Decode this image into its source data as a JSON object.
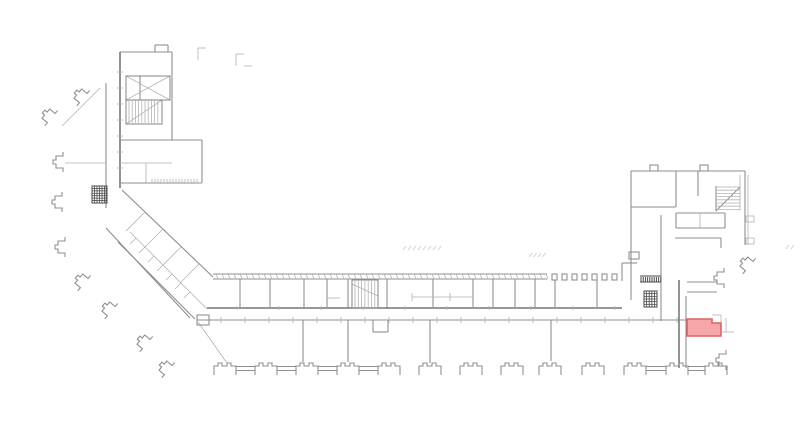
{
  "meta": {
    "width": 800,
    "height": 428,
    "background": "#ffffff",
    "description": "architectural floor plan with one room highlighted"
  },
  "styles": {
    "w": {
      "c": "#8f8f8f",
      "sw": 1.1
    },
    "W": {
      "c": "#767676",
      "sw": 1.6
    },
    "t": {
      "c": "#b3b3b3",
      "sw": 0.8
    },
    "d": {
      "c": "#4a4a4a",
      "sw": 1.0
    },
    "f": {
      "c": "#cfcfcf",
      "sw": 0.9
    }
  },
  "highlight": {
    "fill": "#f6a6a6",
    "stroke": "#da6363",
    "stroke_width": 1.6,
    "points": "687,319 712,319 712,323 721,323 721,336 687,336"
  },
  "plan": {
    "segments": [
      [
        155,
        45,
        168,
        45,
        "w"
      ],
      [
        155,
        45,
        155,
        52,
        "w"
      ],
      [
        168,
        45,
        168,
        52,
        "w"
      ],
      [
        120,
        52,
        172,
        52,
        "w"
      ],
      [
        120,
        52,
        120,
        188,
        "W"
      ],
      [
        172,
        52,
        172,
        140,
        "w"
      ],
      [
        140,
        76,
        140,
        100,
        "w"
      ],
      [
        126,
        76,
        170,
        100,
        "t"
      ],
      [
        126,
        100,
        170,
        76,
        "t"
      ],
      [
        126,
        124,
        162,
        100,
        "t"
      ],
      [
        120,
        140,
        172,
        140,
        "w"
      ],
      [
        120,
        163,
        172,
        163,
        "t"
      ],
      [
        146,
        163,
        146,
        183,
        "t"
      ],
      [
        152,
        140,
        202,
        140,
        "w"
      ],
      [
        202,
        140,
        202,
        183,
        "w"
      ],
      [
        120,
        183,
        202,
        183,
        "w"
      ],
      [
        106,
        83,
        106,
        208,
        "w"
      ],
      [
        65,
        163,
        106,
        163,
        "t"
      ],
      [
        100,
        88,
        62,
        126,
        "t"
      ],
      [
        198,
        48,
        198,
        60,
        "t"
      ],
      [
        198,
        48,
        206,
        48,
        "t"
      ],
      [
        236,
        54,
        236,
        66,
        "t"
      ],
      [
        236,
        54,
        244,
        54,
        "t"
      ],
      [
        244,
        66,
        252,
        66,
        "t"
      ],
      [
        122,
        190,
        213,
        277,
        "w"
      ],
      [
        106,
        228,
        190,
        318,
        "w"
      ],
      [
        118,
        242,
        195,
        319,
        "w"
      ],
      [
        130,
        232,
        207,
        309,
        "t"
      ],
      [
        145,
        212,
        126,
        231,
        "t"
      ],
      [
        163,
        229,
        144,
        248,
        "t"
      ],
      [
        181,
        247,
        162,
        266,
        "t"
      ],
      [
        199,
        264,
        180,
        283,
        "t"
      ],
      [
        198,
        322,
        227,
        363,
        "t"
      ],
      [
        213,
        274,
        547,
        274,
        "w"
      ],
      [
        213,
        279,
        547,
        279,
        "w"
      ],
      [
        240,
        279,
        240,
        307,
        "w"
      ],
      [
        270,
        279,
        270,
        307,
        "w"
      ],
      [
        304,
        279,
        304,
        307,
        "w"
      ],
      [
        327,
        279,
        327,
        307,
        "w"
      ],
      [
        327,
        298,
        340,
        298,
        "t"
      ],
      [
        348,
        279,
        348,
        308,
        "w"
      ],
      [
        387,
        279,
        387,
        308,
        "w"
      ],
      [
        352,
        284,
        378,
        296,
        "t"
      ],
      [
        433,
        279,
        433,
        307,
        "w"
      ],
      [
        473,
        279,
        473,
        307,
        "w"
      ],
      [
        493,
        279,
        493,
        307,
        "w"
      ],
      [
        515,
        279,
        515,
        307,
        "w"
      ],
      [
        535,
        279,
        535,
        307,
        "w"
      ],
      [
        555,
        280,
        555,
        307,
        "w"
      ],
      [
        597,
        280,
        597,
        307,
        "w"
      ],
      [
        412,
        297,
        472,
        297,
        "t"
      ],
      [
        412,
        293,
        412,
        301,
        "t"
      ],
      [
        450,
        293,
        450,
        301,
        "t"
      ],
      [
        207,
        308,
        622,
        308,
        "W"
      ],
      [
        197,
        320,
        686,
        320,
        "w"
      ],
      [
        373,
        320,
        373,
        332,
        "w"
      ],
      [
        388,
        320,
        388,
        332,
        "w"
      ],
      [
        373,
        332,
        388,
        332,
        "w"
      ],
      [
        303,
        320,
        303,
        362,
        "w"
      ],
      [
        348,
        320,
        348,
        362,
        "w"
      ],
      [
        430,
        320,
        430,
        363,
        "w"
      ],
      [
        551,
        320,
        551,
        361,
        "w"
      ],
      [
        679,
        280,
        679,
        368,
        "W"
      ],
      [
        686,
        296,
        686,
        368,
        "w"
      ],
      [
        631,
        171,
        745,
        171,
        "w"
      ],
      [
        745,
        171,
        745,
        245,
        "w"
      ],
      [
        631,
        171,
        631,
        300,
        "w"
      ],
      [
        631,
        207,
        676,
        207,
        "w"
      ],
      [
        676,
        171,
        676,
        207,
        "w"
      ],
      [
        698,
        171,
        698,
        196,
        "w"
      ],
      [
        676,
        213,
        725,
        213,
        "w"
      ],
      [
        676,
        213,
        676,
        228,
        "w"
      ],
      [
        725,
        213,
        725,
        228,
        "w"
      ],
      [
        676,
        228,
        725,
        228,
        "w"
      ],
      [
        700,
        213,
        700,
        228,
        "t"
      ],
      [
        675,
        238,
        721,
        238,
        "w"
      ],
      [
        721,
        238,
        721,
        248,
        "w"
      ],
      [
        716,
        186,
        716,
        211,
        "w"
      ],
      [
        740,
        175,
        740,
        211,
        "t"
      ],
      [
        716,
        211,
        740,
        187,
        "w"
      ],
      [
        661,
        215,
        661,
        321,
        "w"
      ],
      [
        622,
        263,
        622,
        281,
        "w"
      ],
      [
        622,
        263,
        637,
        263,
        "w"
      ],
      [
        640,
        276,
        661,
        276,
        "d"
      ],
      [
        640,
        282,
        661,
        282,
        "d"
      ],
      [
        687,
        282,
        717,
        282,
        "w"
      ],
      [
        687,
        292,
        717,
        292,
        "w"
      ],
      [
        748,
        175,
        748,
        245,
        "t"
      ],
      [
        712,
        315,
        721,
        315,
        "t"
      ],
      [
        721,
        315,
        721,
        323,
        "t"
      ],
      [
        726,
        318,
        726,
        332,
        "t"
      ],
      [
        722,
        332,
        734,
        332,
        "t"
      ]
    ],
    "rects": [
      [
        126,
        76,
        44,
        24,
        "w"
      ],
      [
        126,
        100,
        36,
        24,
        "w"
      ],
      [
        352,
        280,
        26,
        28,
        "w"
      ],
      [
        197,
        315,
        12,
        10,
        "w"
      ],
      [
        650,
        165,
        8,
        6,
        "w"
      ],
      [
        700,
        165,
        8,
        6,
        "w"
      ],
      [
        629,
        252,
        10,
        7,
        "w"
      ],
      [
        746,
        216,
        8,
        6,
        "t"
      ],
      [
        746,
        238,
        8,
        6,
        "t"
      ],
      [
        552,
        274,
        5,
        6,
        "w"
      ],
      [
        562,
        274,
        5,
        6,
        "w"
      ],
      [
        572,
        274,
        5,
        6,
        "w"
      ],
      [
        582,
        274,
        5,
        6,
        "w"
      ],
      [
        592,
        274,
        5,
        6,
        "w"
      ],
      [
        602,
        274,
        5,
        6,
        "w"
      ],
      [
        612,
        274,
        5,
        6,
        "w"
      ]
    ],
    "ticks": [
      {
        "x": 216,
        "y": 274,
        "sx": 6,
        "sy": 0,
        "n": 56,
        "tx": 2,
        "ty": 5,
        "c": "t"
      },
      {
        "x": 221,
        "y": 317,
        "sx": 24,
        "sy": 0,
        "n": 20,
        "tx": 0,
        "ty": 6,
        "c": "t"
      },
      {
        "x": 237,
        "y": 306,
        "sx": 42,
        "sy": 0,
        "n": 10,
        "tx": 0,
        "ty": 4,
        "c": "t"
      },
      {
        "x": 129,
        "y": 101,
        "sx": 3.2,
        "sy": 0,
        "n": 10,
        "tx": 0,
        "ty": 22,
        "c": "t"
      },
      {
        "x": 355,
        "y": 281,
        "sx": 3.3,
        "sy": 0,
        "n": 7,
        "tx": 0,
        "ty": 26,
        "c": "t"
      },
      {
        "x": 716,
        "y": 187,
        "sx": 0,
        "sy": 3.2,
        "n": 8,
        "tx": 24,
        "ty": 0,
        "c": "t"
      },
      {
        "x": 641,
        "y": 277,
        "sx": 2.2,
        "sy": 0,
        "n": 10,
        "tx": 0,
        "ty": 5,
        "c": "d"
      },
      {
        "x": 152,
        "y": 179,
        "sx": 3,
        "sy": 0,
        "n": 16,
        "tx": 0,
        "ty": 4,
        "c": "t"
      },
      {
        "x": 117,
        "y": 72,
        "sx": 0,
        "sy": 16,
        "n": 7,
        "tx": 6,
        "ty": 0,
        "c": "t"
      },
      {
        "x": 130,
        "y": 244,
        "sx": 9,
        "sy": 9,
        "n": 7,
        "tx": 6,
        "ty": -6,
        "c": "t"
      }
    ],
    "faint_marks": [
      {
        "x": 403,
        "y": 250,
        "sx": 5,
        "sy": 0,
        "n": 8,
        "tx": 3,
        "ty": -4,
        "c": "f"
      },
      {
        "x": 529,
        "y": 257,
        "sx": 4.5,
        "sy": 0,
        "n": 4,
        "tx": 3,
        "ty": -4,
        "c": "f"
      },
      {
        "x": 786,
        "y": 249,
        "sx": 5,
        "sy": 0,
        "n": 2,
        "tx": 3,
        "ty": -4,
        "c": "f"
      }
    ],
    "crosshatch": {
      "color": "#4a4a4a",
      "items": [
        {
          "x": 92,
          "y": 186,
          "w": 15,
          "h": 17,
          "nx": 6,
          "ny": 7
        },
        {
          "x": 644,
          "y": 291,
          "w": 13,
          "h": 16,
          "nx": 5,
          "ny": 6
        }
      ]
    },
    "pillars": {
      "y": 362,
      "path": "M0,13 V4 H4 V1 H8 V4 H13 V1 H17 V4 H22 V13",
      "xs": [
        214,
        255,
        296,
        337,
        378,
        419,
        460,
        501,
        539,
        582,
        624,
        666,
        705
      ],
      "links": [
        [
          236,
          255
        ],
        [
          277,
          296
        ],
        [
          318,
          337
        ],
        [
          359,
          378
        ],
        [
          646,
          666
        ],
        [
          688,
          705
        ]
      ],
      "link_y1": 366.5,
      "link_y2": 370.5
    },
    "brackets": {
      "path": "M10,0 V4 H3 V8 H0 V12 H3 V16 H10 V20",
      "items": [
        [
          82,
          84,
          40
        ],
        [
          50,
          104,
          40
        ],
        [
          53,
          152,
          0
        ],
        [
          52,
          192,
          0
        ],
        [
          55,
          237,
          0
        ],
        [
          83,
          269,
          40
        ],
        [
          110,
          297,
          40
        ],
        [
          145,
          330,
          40
        ],
        [
          167,
          356,
          40
        ],
        [
          714,
          268,
          0
        ],
        [
          716,
          350,
          0
        ],
        [
          748,
          252,
          40
        ]
      ]
    }
  }
}
